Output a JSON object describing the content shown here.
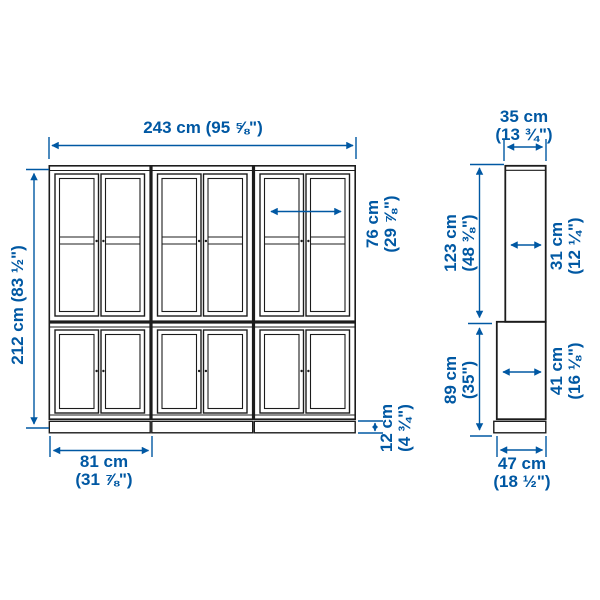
{
  "drawing": {
    "accent_color": "#0058a3",
    "line_color": "#1c1c1c",
    "subject": "storage combination with glass doors, front and side elevation"
  },
  "front_view": {
    "total_width": {
      "label": "243 cm (95 ⅝\")"
    },
    "total_height": {
      "label": "212 cm (83 ½\")"
    },
    "inner_width": {
      "metric": "76 cm",
      "imperial": "(29 ⅞\")"
    },
    "unit_width": {
      "metric": "81 cm",
      "imperial": "(31 ⅞\")"
    },
    "plinth_height": {
      "metric": "12 cm",
      "imperial": "(4 ¾\")"
    }
  },
  "side_view": {
    "top_depth": {
      "metric": "35 cm",
      "imperial": "(13 ¾\")"
    },
    "upper_height": {
      "metric": "123 cm",
      "imperial": "(48 ⅜\")"
    },
    "upper_inner_depth": {
      "metric": "31 cm",
      "imperial": "(12 ¼\")"
    },
    "lower_height": {
      "metric": "89 cm",
      "imperial": "(35\")"
    },
    "lower_inner_depth": {
      "metric": "41 cm",
      "imperial": "(16 ⅛\")"
    },
    "bottom_depth": {
      "metric": "47 cm",
      "imperial": "(18 ½\")"
    }
  }
}
